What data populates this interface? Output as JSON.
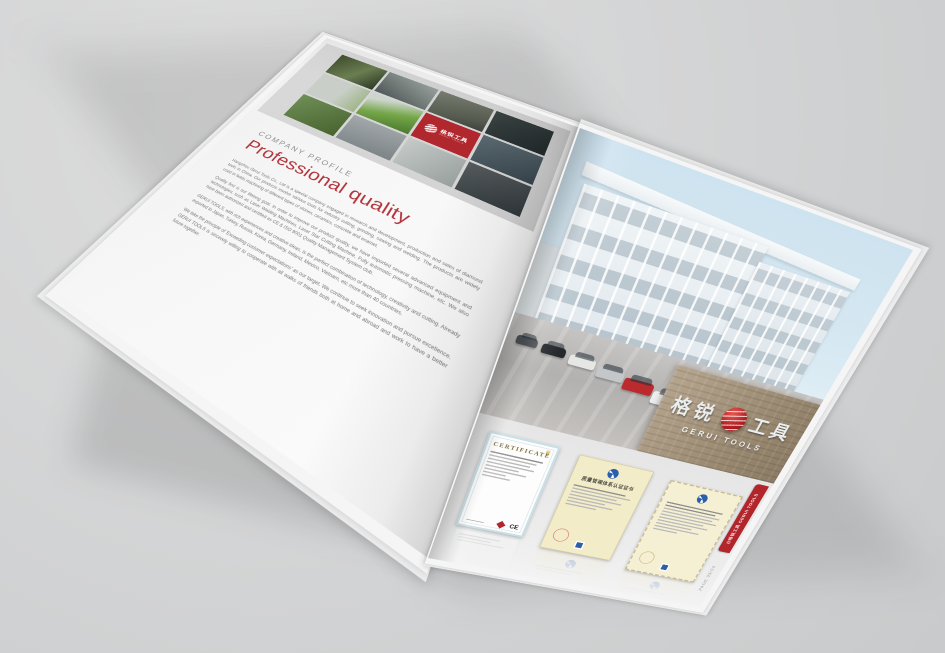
{
  "document": {
    "type": "company-brochure-spread-mockup",
    "page_label": "PAGE 03/04"
  },
  "brand": {
    "name_cn": "格锐工具",
    "name_en": "GERUI TOOLS",
    "red": "#b1272e"
  },
  "left_page": {
    "kicker": "COMPANY PROFILE",
    "title": "Professional quality",
    "title_color": "#b3353c",
    "paragraphs": [
      "Hangzhou Gerui Tools Co., Ltd is a special company engaged in research and development, production and sales of diamond tools in China. Our products involve various tools for industry cutting, grinding, sawing and welding. The products are widely used in fields machining of different types of stones, ceramics, concrete and enamel.",
      "Quality first is our lifelong goal. In order to improve our product quality, we have imported several advanced equipment and technologies, such as Laser Welding Machines, Laser Star Cutting Machine, Fully automatic pressing machine, etc. We also have been authorized and certified as CE & ISO 9001 Quality Management System club.",
      "GERUI TOOLS, with rich experiences and creative ideas, is the perfect combination of technology, creativity and cutting. Already exported to Japan, Turkey, Russia, Korea, Germany, Ireland, Mexico, Vietnam, etc more than 40 countries.",
      "We take the principle of 'Exceeding customer expectations' as our target. We continue to seek innovation and pursue excellence. GERUI TOOLS is sincerely willing to cooperate with all walks of friends both at home and abroad and work to have a better future together."
    ],
    "collage_photos": [
      "factory-machinery",
      "workshop-interior",
      "production-staff",
      "dark-machinery",
      "assembly-room",
      "green-machine",
      "brand-logo-tile",
      "workers-line",
      "green-equipment",
      "cnc-machines",
      "bright-workshop",
      "tooling-machines"
    ]
  },
  "right_page": {
    "photo": "company-building-exterior",
    "wall_cn_left": "格锐",
    "wall_cn_right": "工具",
    "wall_en": "GERUI TOOLS",
    "edge_tab": "@格锐工具 GERUI TOOLS",
    "page_label": "PAGE 03/04"
  },
  "certificates": {
    "ce": {
      "title": "CERTIFICATE",
      "mark": "CE"
    },
    "iso_cn": {
      "title": "质量管理体系认证证书"
    }
  }
}
